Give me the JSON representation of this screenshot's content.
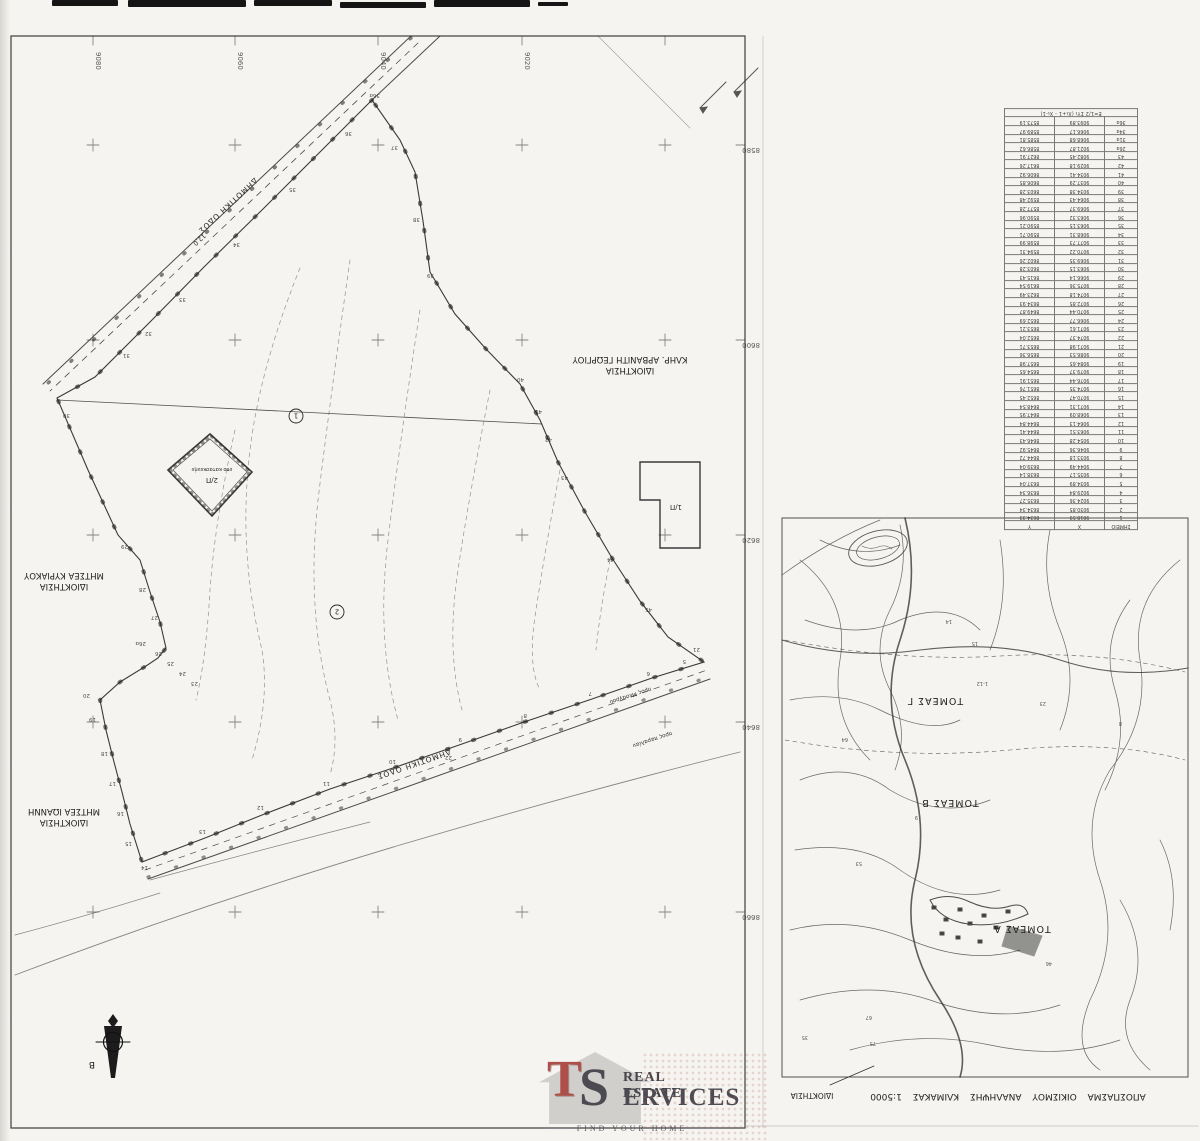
{
  "survey_map": {
    "grid_x_labels": [
      "9080",
      "9060",
      "9040",
      "9020"
    ],
    "grid_y_labels": [
      "8580",
      "8600",
      "8620",
      "8640",
      "8660"
    ],
    "top_road": {
      "name": "ΔΗΜΟΤΙΚΗ ΟΔΟΣ",
      "width": "12.0"
    },
    "bottom_road": {
      "name": "ΔΗΜΟΤΙΚΗ ΟΔΟΣ"
    },
    "direction_notes": [
      "προς Μεσαγρού",
      "προς παραλίαν"
    ],
    "owners": [
      {
        "line1": "ΙΔΙΟΚΤΗΣΙΑ",
        "line2": "ΚΛΗΡ. ΑΡΒΑΝΙΤΗ ΓΕΩΡΓΙΟΥ"
      },
      {
        "line1": "ΙΔΙΟΚΤΗΣΙΑ",
        "line2": "ΜΗΤΣΕΑ ΚΥΡΙΑΚΟΥ"
      },
      {
        "line1": "ΙΔΙΟΚΤΗΣΙΑ",
        "line2": "ΜΗΤΣΕΑ ΙΩΑΝΝΗ"
      }
    ],
    "buildings": [
      {
        "label": "2/Π",
        "note": "υπο κατασκευήν"
      },
      {
        "label": "1/Π"
      }
    ],
    "parcel_numbers": [
      "1",
      "2"
    ],
    "north_label": "Β",
    "point_markers": [
      {
        "t": "36α",
        "x": 380,
        "y": 94
      },
      {
        "t": "36",
        "x": 352,
        "y": 132
      },
      {
        "t": "35",
        "x": 296,
        "y": 188
      },
      {
        "t": "34",
        "x": 240,
        "y": 243
      },
      {
        "t": "33",
        "x": 186,
        "y": 298
      },
      {
        "t": "32",
        "x": 152,
        "y": 332
      },
      {
        "t": "31",
        "x": 130,
        "y": 354
      },
      {
        "t": "30",
        "x": 70,
        "y": 414
      },
      {
        "t": "29",
        "x": 128,
        "y": 545
      },
      {
        "t": "28",
        "x": 146,
        "y": 588
      },
      {
        "t": "27",
        "x": 158,
        "y": 616
      },
      {
        "t": "26α",
        "x": 146,
        "y": 642
      },
      {
        "t": "26",
        "x": 162,
        "y": 652
      },
      {
        "t": "25",
        "x": 174,
        "y": 662
      },
      {
        "t": "24",
        "x": 186,
        "y": 672
      },
      {
        "t": "23",
        "x": 198,
        "y": 682
      },
      {
        "t": "20",
        "x": 90,
        "y": 694
      },
      {
        "t": "19",
        "x": 96,
        "y": 718
      },
      {
        "t": "18",
        "x": 108,
        "y": 752
      },
      {
        "t": "17",
        "x": 116,
        "y": 782
      },
      {
        "t": "16",
        "x": 124,
        "y": 812
      },
      {
        "t": "15",
        "x": 132,
        "y": 842
      },
      {
        "t": "14",
        "x": 148,
        "y": 866
      },
      {
        "t": "13",
        "x": 206,
        "y": 830
      },
      {
        "t": "12",
        "x": 264,
        "y": 806
      },
      {
        "t": "11",
        "x": 330,
        "y": 782
      },
      {
        "t": "10",
        "x": 396,
        "y": 760
      },
      {
        "t": "9",
        "x": 462,
        "y": 738
      },
      {
        "t": "8",
        "x": 527,
        "y": 714
      },
      {
        "t": "7",
        "x": 592,
        "y": 692
      },
      {
        "t": "6",
        "x": 650,
        "y": 672
      },
      {
        "t": "5",
        "x": 686,
        "y": 660
      },
      {
        "t": "22",
        "x": 452,
        "y": 756
      },
      {
        "t": "21",
        "x": 700,
        "y": 648
      },
      {
        "t": "37",
        "x": 398,
        "y": 146
      },
      {
        "t": "38",
        "x": 420,
        "y": 218
      },
      {
        "t": "39",
        "x": 434,
        "y": 274
      },
      {
        "t": "40",
        "x": 524,
        "y": 378
      },
      {
        "t": "41",
        "x": 542,
        "y": 410
      },
      {
        "t": "42",
        "x": 552,
        "y": 438
      },
      {
        "t": "43",
        "x": 568,
        "y": 476
      },
      {
        "t": "44",
        "x": 614,
        "y": 558
      },
      {
        "t": "45",
        "x": 652,
        "y": 608
      }
    ]
  },
  "coords_table": {
    "headers": [
      "ΣΗΜΕΙΟ",
      "X",
      "Y"
    ],
    "formula": "Ε=1/2 ΣΥι (Χι+1 - Χι-1)",
    "rows": [
      [
        "1",
        "9018.59",
        "8634.33"
      ],
      [
        "2",
        "9030.85",
        "8634.34"
      ],
      [
        "3",
        "9024.36",
        "8635.27"
      ],
      [
        "4",
        "9029.84",
        "8636.34"
      ],
      [
        "5",
        "9034.89",
        "8637.04"
      ],
      [
        "6",
        "9035.17",
        "8638.14"
      ],
      [
        "7",
        "9044.49",
        "8639.04"
      ],
      [
        "8",
        "9033.18",
        "8644.72"
      ],
      [
        "9",
        "9046.36",
        "8645.92"
      ],
      [
        "10",
        "9054.28",
        "8646.43"
      ],
      [
        "11",
        "9063.51",
        "8644.41"
      ],
      [
        "12",
        "9064.13",
        "8644.84"
      ],
      [
        "13",
        "9068.09",
        "8647.95"
      ],
      [
        "14",
        "9071.31",
        "8648.54"
      ],
      [
        "15",
        "9070.47",
        "8652.45"
      ],
      [
        "16",
        "9074.35",
        "8651.76"
      ],
      [
        "17",
        "9076.44",
        "8651.91"
      ],
      [
        "18",
        "9079.37",
        "8654.65"
      ],
      [
        "19",
        "9084.65",
        "8657.98"
      ],
      [
        "20",
        "9086.53",
        "8656.36"
      ],
      [
        "21",
        "9071.98",
        "8653.71"
      ],
      [
        "22",
        "9074.37",
        "8652.04"
      ],
      [
        "23",
        "9071.61",
        "8653.21"
      ],
      [
        "24",
        "9066.77",
        "8652.69"
      ],
      [
        "25",
        "9070.44",
        "8649.87"
      ],
      [
        "26",
        "9072.85",
        "8634.93"
      ],
      [
        "27",
        "9074.18",
        "8623.49"
      ],
      [
        "28",
        "9075.36",
        "8619.54"
      ],
      [
        "29",
        "9066.14",
        "8615.43"
      ],
      [
        "30",
        "9063.15",
        "8603.28"
      ],
      [
        "31",
        "9069.35",
        "8602.26"
      ],
      [
        "32",
        "9070.22",
        "8594.31"
      ],
      [
        "33",
        "9077.73",
        "8598.99"
      ],
      [
        "34",
        "9068.31",
        "8590.71"
      ],
      [
        "35",
        "9063.15",
        "8590.21"
      ],
      [
        "36",
        "9063.32",
        "8590.96"
      ],
      [
        "37",
        "9069.37",
        "8577.28"
      ],
      [
        "38",
        "9064.43",
        "8592.48"
      ],
      [
        "39",
        "9034.38",
        "8603.28"
      ],
      [
        "40",
        "9037.29",
        "8606.85"
      ],
      [
        "41",
        "9034.41",
        "8606.92"
      ],
      [
        "42",
        "9029.18",
        "8617.26"
      ],
      [
        "43",
        "9082.45",
        "8627.91"
      ],
      [
        "26α",
        "9021.87",
        "8586.62"
      ],
      [
        "31α",
        "9068.68",
        "8585.81"
      ],
      [
        "34α",
        "9066.17",
        "8589.97"
      ],
      [
        "36α",
        "9093.89",
        "8573.19"
      ]
    ]
  },
  "inset_map": {
    "sectors": [
      "ΤΟΜΕΑΣ Γ",
      "ΤΟΜΕΑΣ Β",
      "ΤΟΜΕΑΣ Α"
    ],
    "caption": "ΑΠΟΣΠΑΣΜΑ  ΟΙΚΙΣΜΟΥ  ΑΝΑΛΗΨΗΣ  ΚΛΙΜΑΚΑΣ 1:5000",
    "ownership_label": "ΙΔΙΟΚΤΗΣΙΑ",
    "markers": [
      {
        "t": "64",
        "x": 848,
        "y": 738
      },
      {
        "t": "53",
        "x": 862,
        "y": 862
      },
      {
        "t": "14",
        "x": 952,
        "y": 620
      },
      {
        "t": "15",
        "x": 978,
        "y": 642
      },
      {
        "t": "9",
        "x": 918,
        "y": 816
      },
      {
        "t": "23",
        "x": 1046,
        "y": 702
      },
      {
        "t": "1-12",
        "x": 988,
        "y": 682
      },
      {
        "t": "8",
        "x": 1122,
        "y": 722
      },
      {
        "t": "46",
        "x": 1052,
        "y": 962
      },
      {
        "t": "67",
        "x": 872,
        "y": 1016
      },
      {
        "t": "75",
        "x": 876,
        "y": 1042
      },
      {
        "t": "35",
        "x": 808,
        "y": 1036
      }
    ]
  },
  "logo": {
    "monogram_t": "T",
    "monogram_s": "S",
    "line1": "REAL ESTATE",
    "line2": "ERVICES",
    "tagline": "FIND YOUR HOME",
    "red": "#a8403c",
    "dark": "#3d3c45"
  }
}
